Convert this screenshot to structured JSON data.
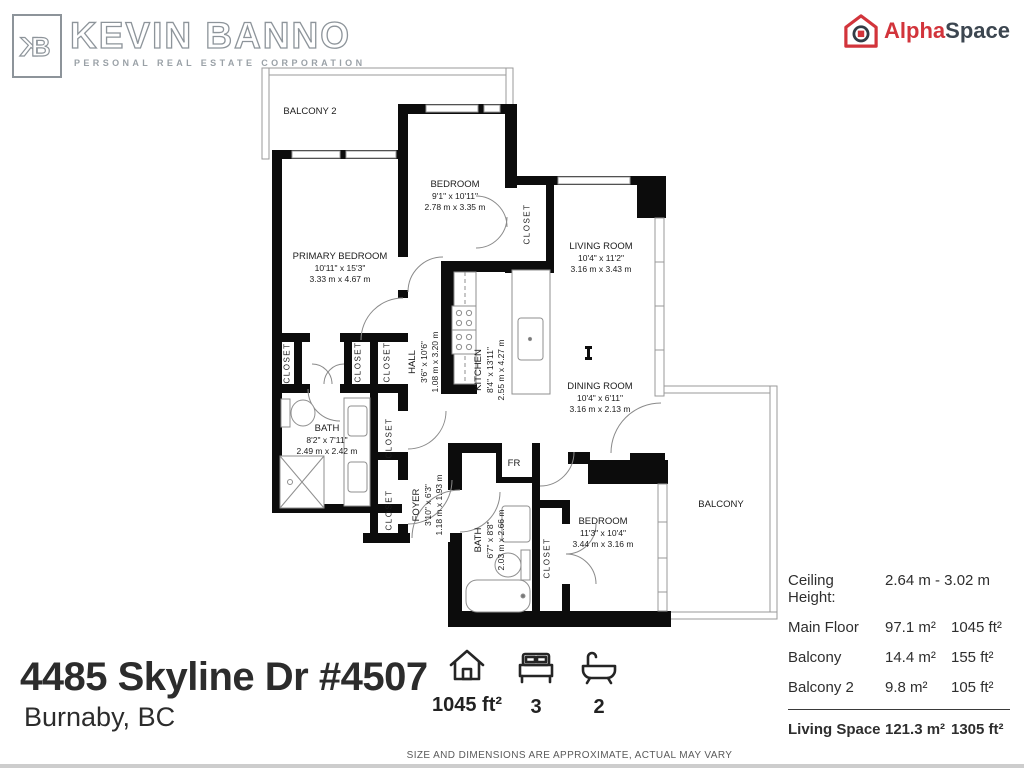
{
  "branding": {
    "monogram_k": "K",
    "monogram_b": "B",
    "agent_name": "KEVIN BANNO",
    "agent_subtitle": "PERSONAL REAL ESTATE CORPORATION",
    "provider_alpha": "Alpha",
    "provider_space": "Space",
    "provider_red": "#d2343b",
    "provider_dark": "#3c4650"
  },
  "listing": {
    "address": "4485 Skyline Dr #4507",
    "city": "Burnaby, BC"
  },
  "stats": {
    "area": "1045 ft²",
    "beds": "3",
    "baths": "2"
  },
  "area_table": {
    "ceiling_label": "Ceiling Height:",
    "ceiling_value": "2.64 m - 3.02 m",
    "rows": [
      {
        "label": "Main Floor",
        "metric": "97.1 m²",
        "imperial": "1045 ft²"
      },
      {
        "label": "Balcony",
        "metric": "14.4 m²",
        "imperial": "155 ft²"
      },
      {
        "label": "Balcony 2",
        "metric": "9.8 m²",
        "imperial": "105 ft²"
      }
    ],
    "total": {
      "label": "Living Space",
      "metric": "121.3 m²",
      "imperial": "1305 ft²"
    }
  },
  "floorplan": {
    "closet_text": "CLOSET",
    "rooms": [
      {
        "name": "BALCONY 2",
        "x": 310,
        "y": 112,
        "rot": 0
      },
      {
        "name": "BEDROOM",
        "ft": "9'1\" x 10'11\"",
        "m": "2.78 m x 3.35 m",
        "x": 455,
        "y": 196,
        "rot": 0
      },
      {
        "name": "PRIMARY BEDROOM",
        "ft": "10'11\" x 15'3\"",
        "m": "3.33 m x 4.67 m",
        "x": 340,
        "y": 268,
        "rot": 0
      },
      {
        "name": "LIVING ROOM",
        "ft": "10'4\" x 11'2\"",
        "m": "3.16 m x 3.43 m",
        "x": 601,
        "y": 258,
        "rot": 0
      },
      {
        "name": "DINING ROOM",
        "ft": "10'4\" x 6'11\"",
        "m": "3.16 m x 2.13 m",
        "x": 600,
        "y": 398,
        "rot": 0
      },
      {
        "name": "KITCHEN",
        "ft": "8'4\" x 13'11\"",
        "m": "2.55 m x 4.27 m",
        "x": 490,
        "y": 370,
        "rot": -90
      },
      {
        "name": "HALL",
        "ft": "3'6\" x 10'6\"",
        "m": "1.08 m x 3.20 m",
        "x": 424,
        "y": 362,
        "rot": -90
      },
      {
        "name": "BATH",
        "ft": "8'2\" x 7'11\"",
        "m": "2.49 m x 2.42 m",
        "x": 327,
        "y": 440,
        "rot": 0
      },
      {
        "name": "FOYER",
        "ft": "3'10\" x 6'3\"",
        "m": "1.18 m x 1.93 m",
        "x": 428,
        "y": 505,
        "rot": -90
      },
      {
        "name": "BATH",
        "ft": "6'7\" x 8'8\"",
        "m": "2.03 m x 2.66 m",
        "x": 490,
        "y": 540,
        "rot": -90
      },
      {
        "name": "BEDROOM",
        "ft": "11'3\" x 10'4\"",
        "m": "3.44 m x 3.16 m",
        "x": 603,
        "y": 533,
        "rot": 0
      },
      {
        "name": "BALCONY",
        "x": 721,
        "y": 505,
        "rot": 0
      },
      {
        "name": "FR",
        "x": 514,
        "y": 464,
        "rot": 0
      }
    ],
    "closets": [
      {
        "x": 527,
        "y": 224
      },
      {
        "x": 287,
        "y": 363
      },
      {
        "x": 358,
        "y": 362
      },
      {
        "x": 387,
        "y": 362
      },
      {
        "x": 389,
        "y": 438
      },
      {
        "x": 389,
        "y": 510
      },
      {
        "x": 547,
        "y": 558
      }
    ]
  },
  "disclaimer": "SIZE AND DIMENSIONS ARE APPROXIMATE, ACTUAL MAY VARY"
}
